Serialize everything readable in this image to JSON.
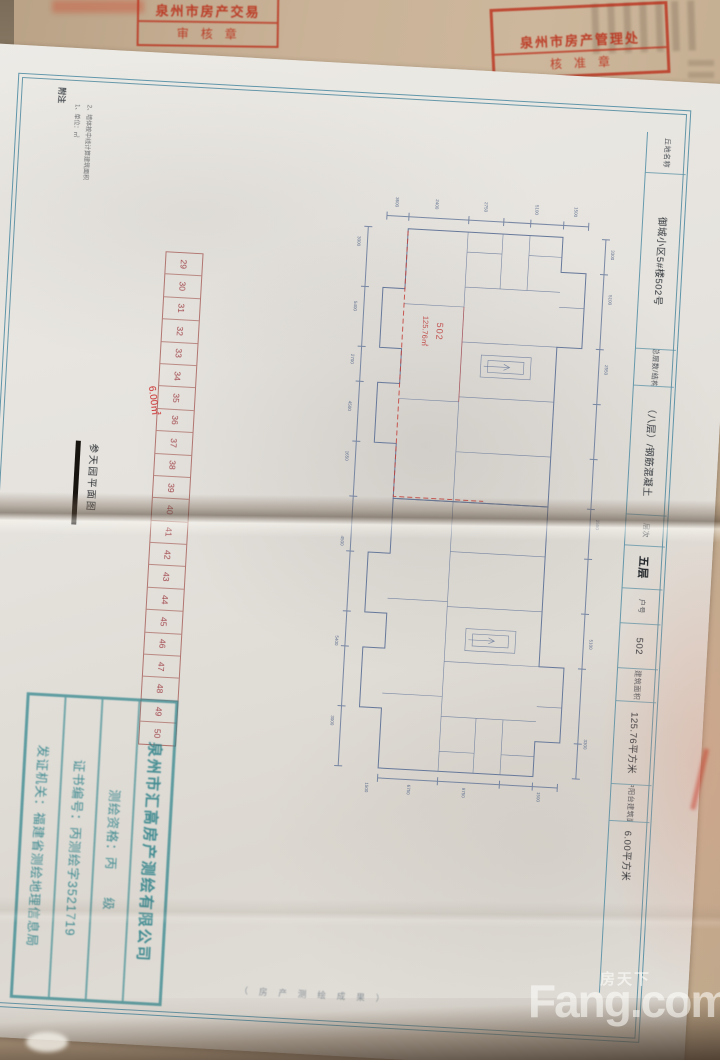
{
  "stamps": {
    "top_left": {
      "line1": "泉州市房产交易",
      "line2": "审核章"
    },
    "top_right": {
      "line1": "泉州市房产管理处",
      "line2": "核准章"
    }
  },
  "sheet": {
    "notes": {
      "title": "附注",
      "items": [
        "1、单位：㎡",
        "2、墙体按中线计算建筑面积"
      ]
    },
    "caption": "参天园平面图",
    "margin_note": "（房产测绘成果）",
    "unit_grid": {
      "numbers": [
        29,
        30,
        31,
        32,
        33,
        34,
        35,
        36,
        37,
        38,
        39,
        40,
        41,
        42,
        43,
        44,
        45,
        46,
        47,
        48,
        49,
        50
      ],
      "annotation": "6.00㎡"
    },
    "plan": {
      "unit_label": "502",
      "area_label": "125.76㎡",
      "dims": {
        "top": [
          "3600",
          "2400",
          "2750",
          "5100",
          "1500"
        ],
        "left": [
          "3000",
          "5400",
          "2700",
          "4500",
          "1650",
          "4500",
          "5400",
          "3000"
        ],
        "right": [
          "3300",
          "5100",
          "2550",
          "2550",
          "5100",
          "3300"
        ],
        "bottom": [
          "1500",
          "6750",
          "9750",
          "1500"
        ]
      }
    },
    "title_block": {
      "cells": [
        {
          "text": "丘地名称",
          "w": 40,
          "cls": "lbl"
        },
        {
          "text": "御城小区5#楼502号",
          "w": 175,
          "cls": "val"
        },
        {
          "text": "总层数/结构",
          "w": 36,
          "cls": "lbl"
        },
        {
          "text": "（八层）/钢筋混凝土",
          "w": 128,
          "cls": "val"
        },
        {
          "text": "层次",
          "w": 30,
          "cls": "lbl"
        },
        {
          "text": "五层",
          "w": 42,
          "cls": "val bold"
        },
        {
          "text": "户号",
          "w": 34,
          "cls": "lbl"
        },
        {
          "text": "502",
          "w": 44,
          "cls": "val"
        },
        {
          "text": "建筑面积",
          "w": 32,
          "cls": "lbl"
        },
        {
          "text": "125.76平方米",
          "w": 82,
          "cls": "val"
        },
        {
          "text": "其中阳台建筑面积",
          "w": 36,
          "cls": "lbl"
        },
        {
          "text": "6.00平方米",
          "w": 68,
          "cls": "val"
        }
      ]
    },
    "surveyor_stamp": {
      "line1": "泉州市汇高房产测绘有限公司",
      "line2": "测绘资格：丙　　级",
      "line3": "证书编号：丙测绘字3521719",
      "line4": "发证机关：福建省测绘地理信息局"
    }
  },
  "watermark": {
    "brand": "Fang.com",
    "cn": "房天下"
  },
  "colors": {
    "frame_blue": "#4b8fa3",
    "plan_line": "#66789a",
    "stamp_red": "#ba2c18",
    "surveyor_teal": "#2c848c",
    "annotation_red": "#cb2b2b"
  }
}
